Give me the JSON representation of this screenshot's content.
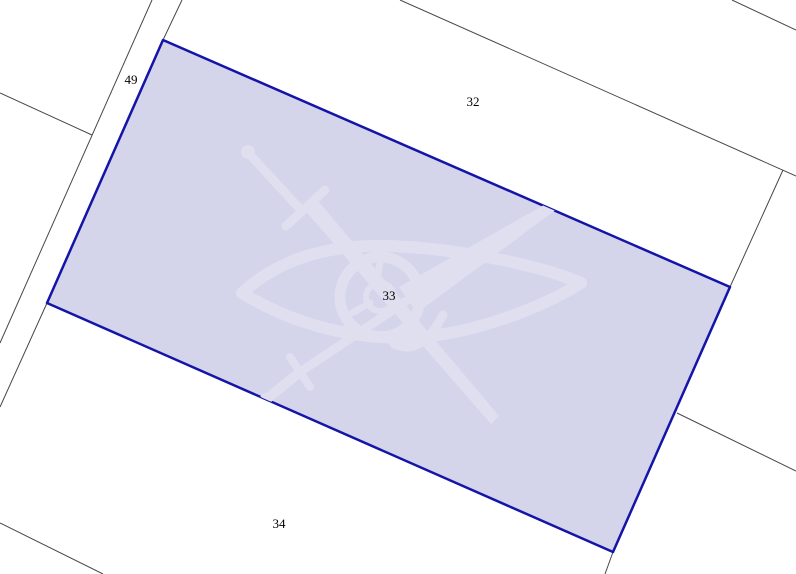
{
  "map": {
    "background_color": "#ffffff",
    "boundary_line_color": "#484848",
    "selected_parcel": {
      "label": "33",
      "fill_color": "#d4d4eb",
      "border_color": "#1414a8"
    },
    "parcels": [
      {
        "label": "49"
      },
      {
        "label": "32"
      },
      {
        "label": "33"
      },
      {
        "label": "34"
      }
    ],
    "watermark": {
      "icon": "eye-with-crossed-swords-watermark",
      "color": "#dfdff0"
    }
  }
}
